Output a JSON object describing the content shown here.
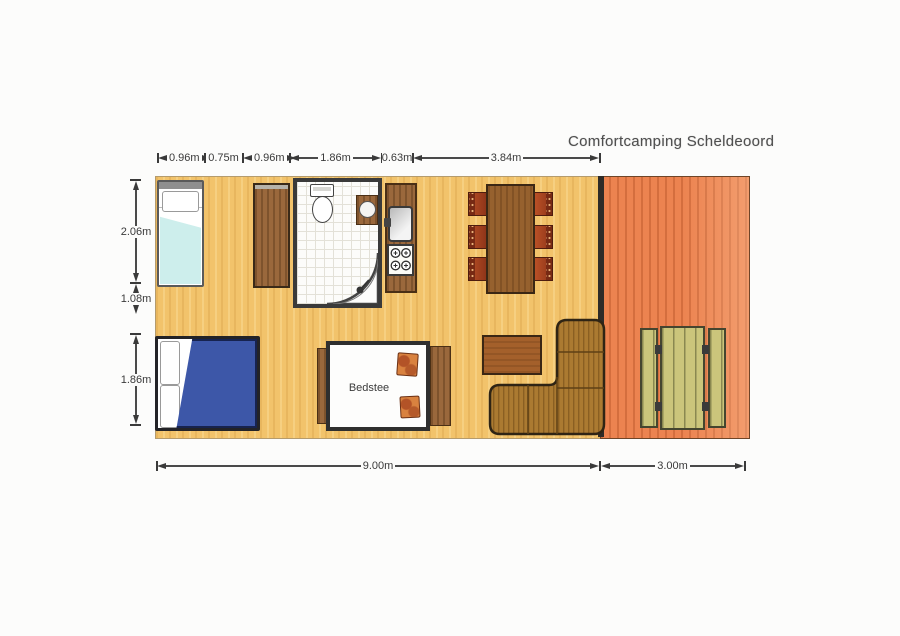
{
  "title": "Comfortcamping Scheldeoord",
  "dimensions": {
    "top": [
      {
        "label": "0.96m"
      },
      {
        "label": "0.75m"
      },
      {
        "label": "0.96m"
      },
      {
        "label": "1.86m"
      },
      {
        "label": "0.63m"
      },
      {
        "label": "3.84m"
      }
    ],
    "left": [
      {
        "label": "2.06m"
      },
      {
        "label": "1.08m"
      },
      {
        "label": "1.86m"
      }
    ],
    "bottom": [
      {
        "label": "9.00m"
      },
      {
        "label": "3.00m"
      }
    ]
  },
  "rooms": {
    "bedstee_label": "Bedstee"
  },
  "colors": {
    "floor": "#f2c36b",
    "terrace": "#ec8350",
    "wood": "#9a683c",
    "dining_table": "#96612e",
    "chair_seat": "#b04a22",
    "chair_back": "#772a14",
    "sofa": "#ab7a31",
    "coffee_table": "#a4602b",
    "single_bed_blanket": "#cdeeec",
    "double_bed_duvet": "#3d57a8",
    "picnic_plank": "#cbc57b",
    "cushion": "#d9823f",
    "wall": "#333333",
    "dimension_text": "#3a3a3a"
  },
  "furniture": [
    "single-bed",
    "wardrobe",
    "bathroom",
    "toilet",
    "shower",
    "washbasin",
    "kitchen-counter",
    "sink",
    "stove",
    "dining-table",
    "dining-chairs",
    "bedstee",
    "double-bed",
    "coffee-table",
    "corner-sofa",
    "terrace",
    "picnic-table"
  ]
}
